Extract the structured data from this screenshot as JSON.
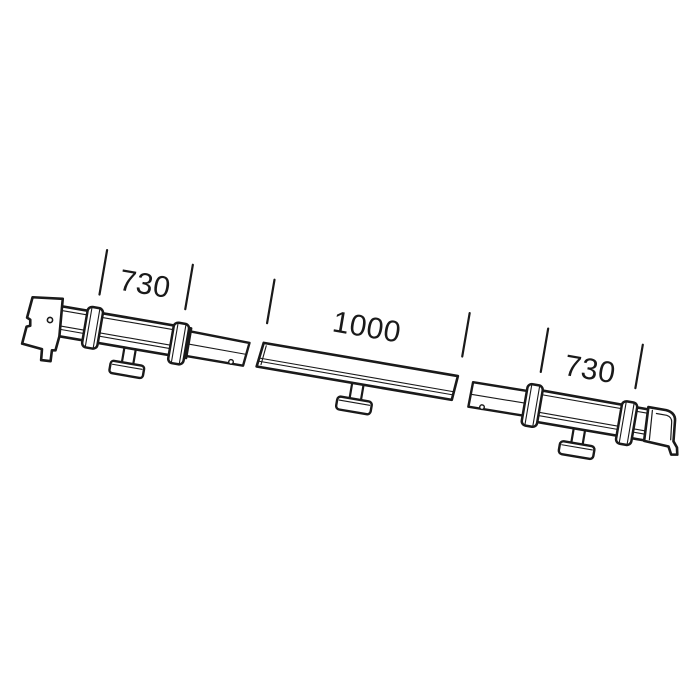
{
  "diagram": {
    "kind": "sectioned-mounting-rail-parts-drawing",
    "colors": {
      "background": "#ffffff",
      "line": "#1a1a1a",
      "fill": "#ffffff"
    },
    "dimensions": [
      {
        "id": "left-section-length",
        "label": "730"
      },
      {
        "id": "middle-section-length",
        "label": "1000"
      },
      {
        "id": "right-section-length",
        "label": "730"
      }
    ]
  }
}
